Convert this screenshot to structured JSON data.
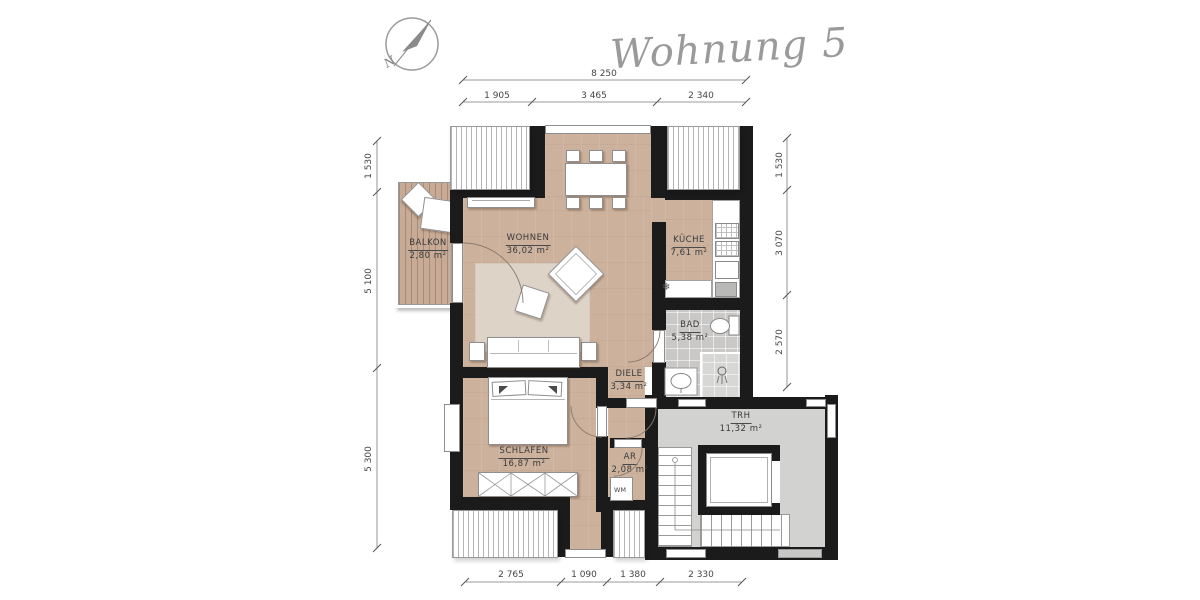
{
  "title": "Wohnung 5",
  "compass": {
    "label": "N"
  },
  "rooms": [
    {
      "id": "balkon",
      "name": "BALKON",
      "area": "2,80 m²"
    },
    {
      "id": "wohnen",
      "name": "WOHNEN",
      "area": "36,02 m²"
    },
    {
      "id": "kueche",
      "name": "KÜCHE",
      "area": "7,61 m²"
    },
    {
      "id": "bad",
      "name": "BAD",
      "area": "5,38 m²"
    },
    {
      "id": "diele",
      "name": "DIELE",
      "area": "3,34 m²"
    },
    {
      "id": "schlafen",
      "name": "SCHLAFEN",
      "area": "16,87 m²"
    },
    {
      "id": "ar",
      "name": "AR",
      "area": "2,08 m²"
    },
    {
      "id": "trh",
      "name": "TRH",
      "area": "11,32 m²"
    }
  ],
  "fixtures": {
    "washing_machine": "WM",
    "freezer_icon": "❄"
  },
  "dimensions": {
    "top_total": "8 250",
    "top_segments": [
      "1 905",
      "3 465",
      "2 340"
    ],
    "left_segments": [
      "1 530",
      "5 100",
      "5 300"
    ],
    "right_segments": [
      "1 530",
      "3 070",
      "2 570"
    ],
    "bottom_segments": [
      "2 765",
      "1 090",
      "1 380",
      "2 330"
    ]
  },
  "colors": {
    "wall": "#1b1b1b",
    "wood_floor": "#ccb19c",
    "rug": "#ded3c7",
    "balcony_wood": "#c7ab96",
    "bath_tile": "#c9c8c6",
    "stairwell_floor": "#d2d2d0",
    "dimension_line": "#777777"
  }
}
